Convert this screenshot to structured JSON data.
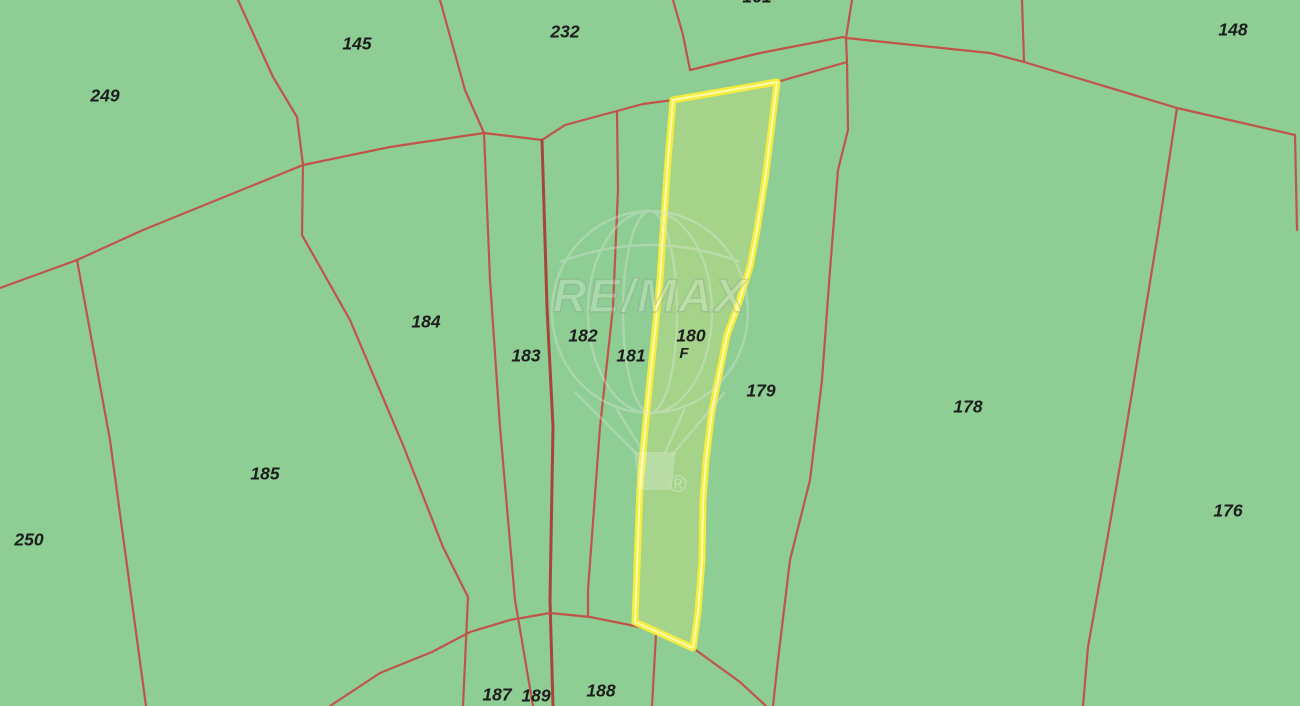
{
  "canvas": {
    "width": 1300,
    "height": 706
  },
  "map": {
    "background_color": "#8ecd94",
    "line_color": "#c0544a",
    "thick_line_color": "#a8453a",
    "label_color": "#1d1d1d",
    "highlight": {
      "outer_stroke": "#f5ed3e",
      "core_stroke": "#fdf9a6",
      "fill": "#a5d38a"
    },
    "selected_parcel": {
      "id": "180",
      "sub_label": "F",
      "label_x": 691,
      "label_y": 337,
      "sub_x": 684,
      "sub_y": 354
    },
    "highlight_outline": [
      [
        673,
        100
      ],
      [
        777,
        82
      ],
      [
        770,
        140
      ],
      [
        765,
        180
      ],
      [
        757,
        230
      ],
      [
        750,
        267
      ],
      [
        738,
        305
      ],
      [
        727,
        335
      ],
      [
        718,
        380
      ],
      [
        712,
        410
      ],
      [
        706,
        460
      ],
      [
        703,
        500
      ],
      [
        702,
        560
      ],
      [
        698,
        612
      ],
      [
        693,
        648
      ],
      [
        653,
        630
      ],
      [
        635,
        622
      ],
      [
        638,
        540
      ],
      [
        640,
        487
      ],
      [
        645,
        430
      ],
      [
        650,
        380
      ],
      [
        655,
        330
      ],
      [
        660,
        280
      ],
      [
        662,
        247
      ],
      [
        666,
        190
      ],
      [
        668,
        160
      ]
    ],
    "parcel_labels": [
      {
        "id": "161",
        "x": 757,
        "y": -2
      },
      {
        "id": "249",
        "x": 105,
        "y": 97
      },
      {
        "id": "145",
        "x": 357,
        "y": 45
      },
      {
        "id": "232",
        "x": 565,
        "y": 33
      },
      {
        "id": "148",
        "x": 1233,
        "y": 31
      },
      {
        "id": "184",
        "x": 426,
        "y": 323
      },
      {
        "id": "183",
        "x": 526,
        "y": 357
      },
      {
        "id": "182",
        "x": 583,
        "y": 337
      },
      {
        "id": "181",
        "x": 631,
        "y": 357
      },
      {
        "id": "179",
        "x": 761,
        "y": 392
      },
      {
        "id": "178",
        "x": 968,
        "y": 408
      },
      {
        "id": "176",
        "x": 1228,
        "y": 512
      },
      {
        "id": "185",
        "x": 265,
        "y": 475
      },
      {
        "id": "250",
        "x": 29,
        "y": 541
      },
      {
        "id": "187",
        "x": 497,
        "y": 696
      },
      {
        "id": "189",
        "x": 536,
        "y": 697
      },
      {
        "id": "188",
        "x": 601,
        "y": 692
      }
    ],
    "boundaries": [
      {
        "name": "boundary-249-145",
        "points": [
          [
            238,
            0
          ],
          [
            273,
            77
          ],
          [
            297,
            117
          ],
          [
            303,
            165
          ]
        ]
      },
      {
        "name": "boundary-249-184",
        "points": [
          [
            303,
            165
          ],
          [
            143,
            230
          ],
          [
            77,
            260
          ]
        ]
      },
      {
        "name": "boundary-249-250",
        "points": [
          [
            77,
            260
          ],
          [
            0,
            288
          ]
        ]
      },
      {
        "name": "boundary-250-185",
        "points": [
          [
            77,
            260
          ],
          [
            110,
            440
          ],
          [
            146,
            706
          ]
        ]
      },
      {
        "name": "boundary-145-184",
        "points": [
          [
            303,
            165
          ],
          [
            390,
            147
          ],
          [
            484,
            133
          ],
          [
            542,
            140
          ],
          [
            565,
            125
          ],
          [
            617,
            111
          ],
          [
            643,
            104
          ],
          [
            673,
            100
          ]
        ]
      },
      {
        "name": "boundary-180-top",
        "points": [
          [
            673,
            100
          ],
          [
            777,
            82
          ],
          [
            847,
            62
          ]
        ]
      },
      {
        "name": "boundary-145-232",
        "points": [
          [
            440,
            0
          ],
          [
            465,
            90
          ],
          [
            484,
            133
          ]
        ]
      },
      {
        "name": "boundary-184-183",
        "points": [
          [
            484,
            133
          ],
          [
            490,
            280
          ],
          [
            500,
            427
          ],
          [
            515,
            600
          ],
          [
            533,
            706
          ]
        ]
      },
      {
        "name": "boundary-183-182",
        "points": [
          [
            542,
            140
          ],
          [
            547,
            307
          ],
          [
            553,
            427
          ],
          [
            550,
            600
          ],
          [
            553,
            706
          ]
        ],
        "thick": true
      },
      {
        "name": "boundary-182-181",
        "points": [
          [
            617,
            111
          ],
          [
            618,
            190
          ],
          [
            613,
            307
          ],
          [
            600,
            427
          ],
          [
            588,
            590
          ],
          [
            588,
            617
          ]
        ]
      },
      {
        "name": "boundary-181-180",
        "points": [
          [
            673,
            100
          ],
          [
            668,
            160
          ],
          [
            662,
            247
          ],
          [
            655,
            330
          ],
          [
            646,
            420
          ],
          [
            640,
            487
          ],
          [
            636,
            560
          ],
          [
            635,
            622
          ]
        ]
      },
      {
        "name": "boundary-184-185",
        "points": [
          [
            303,
            165
          ],
          [
            302,
            235
          ],
          [
            350,
            320
          ],
          [
            403,
            445
          ],
          [
            443,
            547
          ],
          [
            468,
            597
          ],
          [
            463,
            706
          ]
        ]
      },
      {
        "name": "boundary-232-161",
        "points": [
          [
            673,
            0
          ],
          [
            683,
            35
          ],
          [
            690,
            70
          ]
        ]
      },
      {
        "name": "parcel-161-bottom",
        "points": [
          [
            690,
            70
          ],
          [
            760,
            53
          ],
          [
            843,
            37
          ]
        ]
      },
      {
        "name": "parcel-161-right",
        "points": [
          [
            852,
            0
          ],
          [
            846,
            38
          ],
          [
            847,
            62
          ]
        ]
      },
      {
        "name": "connector-161-corner",
        "points": [
          [
            843,
            37
          ],
          [
            846,
            38
          ]
        ]
      },
      {
        "name": "boundary-148-diagonal",
        "points": [
          [
            846,
            38
          ],
          [
            990,
            53
          ],
          [
            1024,
            62
          ],
          [
            1177,
            108
          ],
          [
            1295,
            135
          ]
        ]
      },
      {
        "name": "boundary-148-stub",
        "points": [
          [
            1022,
            0
          ],
          [
            1024,
            62
          ]
        ]
      },
      {
        "name": "boundary-right-edge",
        "points": [
          [
            1295,
            135
          ],
          [
            1297,
            230
          ]
        ]
      },
      {
        "name": "boundary-178-176",
        "points": [
          [
            1177,
            108
          ],
          [
            1158,
            233
          ],
          [
            1123,
            448
          ],
          [
            1108,
            535
          ],
          [
            1088,
            647
          ],
          [
            1083,
            706
          ]
        ]
      },
      {
        "name": "boundary-179-178",
        "points": [
          [
            847,
            62
          ],
          [
            848,
            130
          ],
          [
            838,
            170
          ],
          [
            830,
            270
          ],
          [
            822,
            380
          ],
          [
            810,
            480
          ],
          [
            790,
            560
          ],
          [
            778,
            660
          ],
          [
            773,
            706
          ]
        ]
      },
      {
        "name": "boundary-188-right",
        "points": [
          [
            656,
            634
          ],
          [
            652,
            706
          ]
        ]
      },
      {
        "name": "road-arc",
        "points": [
          [
            330,
            706
          ],
          [
            380,
            673
          ],
          [
            432,
            652
          ],
          [
            470,
            632
          ],
          [
            510,
            620
          ],
          [
            550,
            613
          ],
          [
            590,
            617
          ],
          [
            625,
            624
          ],
          [
            653,
            630
          ],
          [
            693,
            648
          ],
          [
            740,
            682
          ],
          [
            766,
            706
          ]
        ]
      }
    ]
  },
  "watermark": {
    "brand": "RE/MAX",
    "registered": "®",
    "stroke_color": "#dce6d8",
    "text_fill": "rgba(255,255,255,0.62)",
    "text_stroke": "#93a693"
  }
}
